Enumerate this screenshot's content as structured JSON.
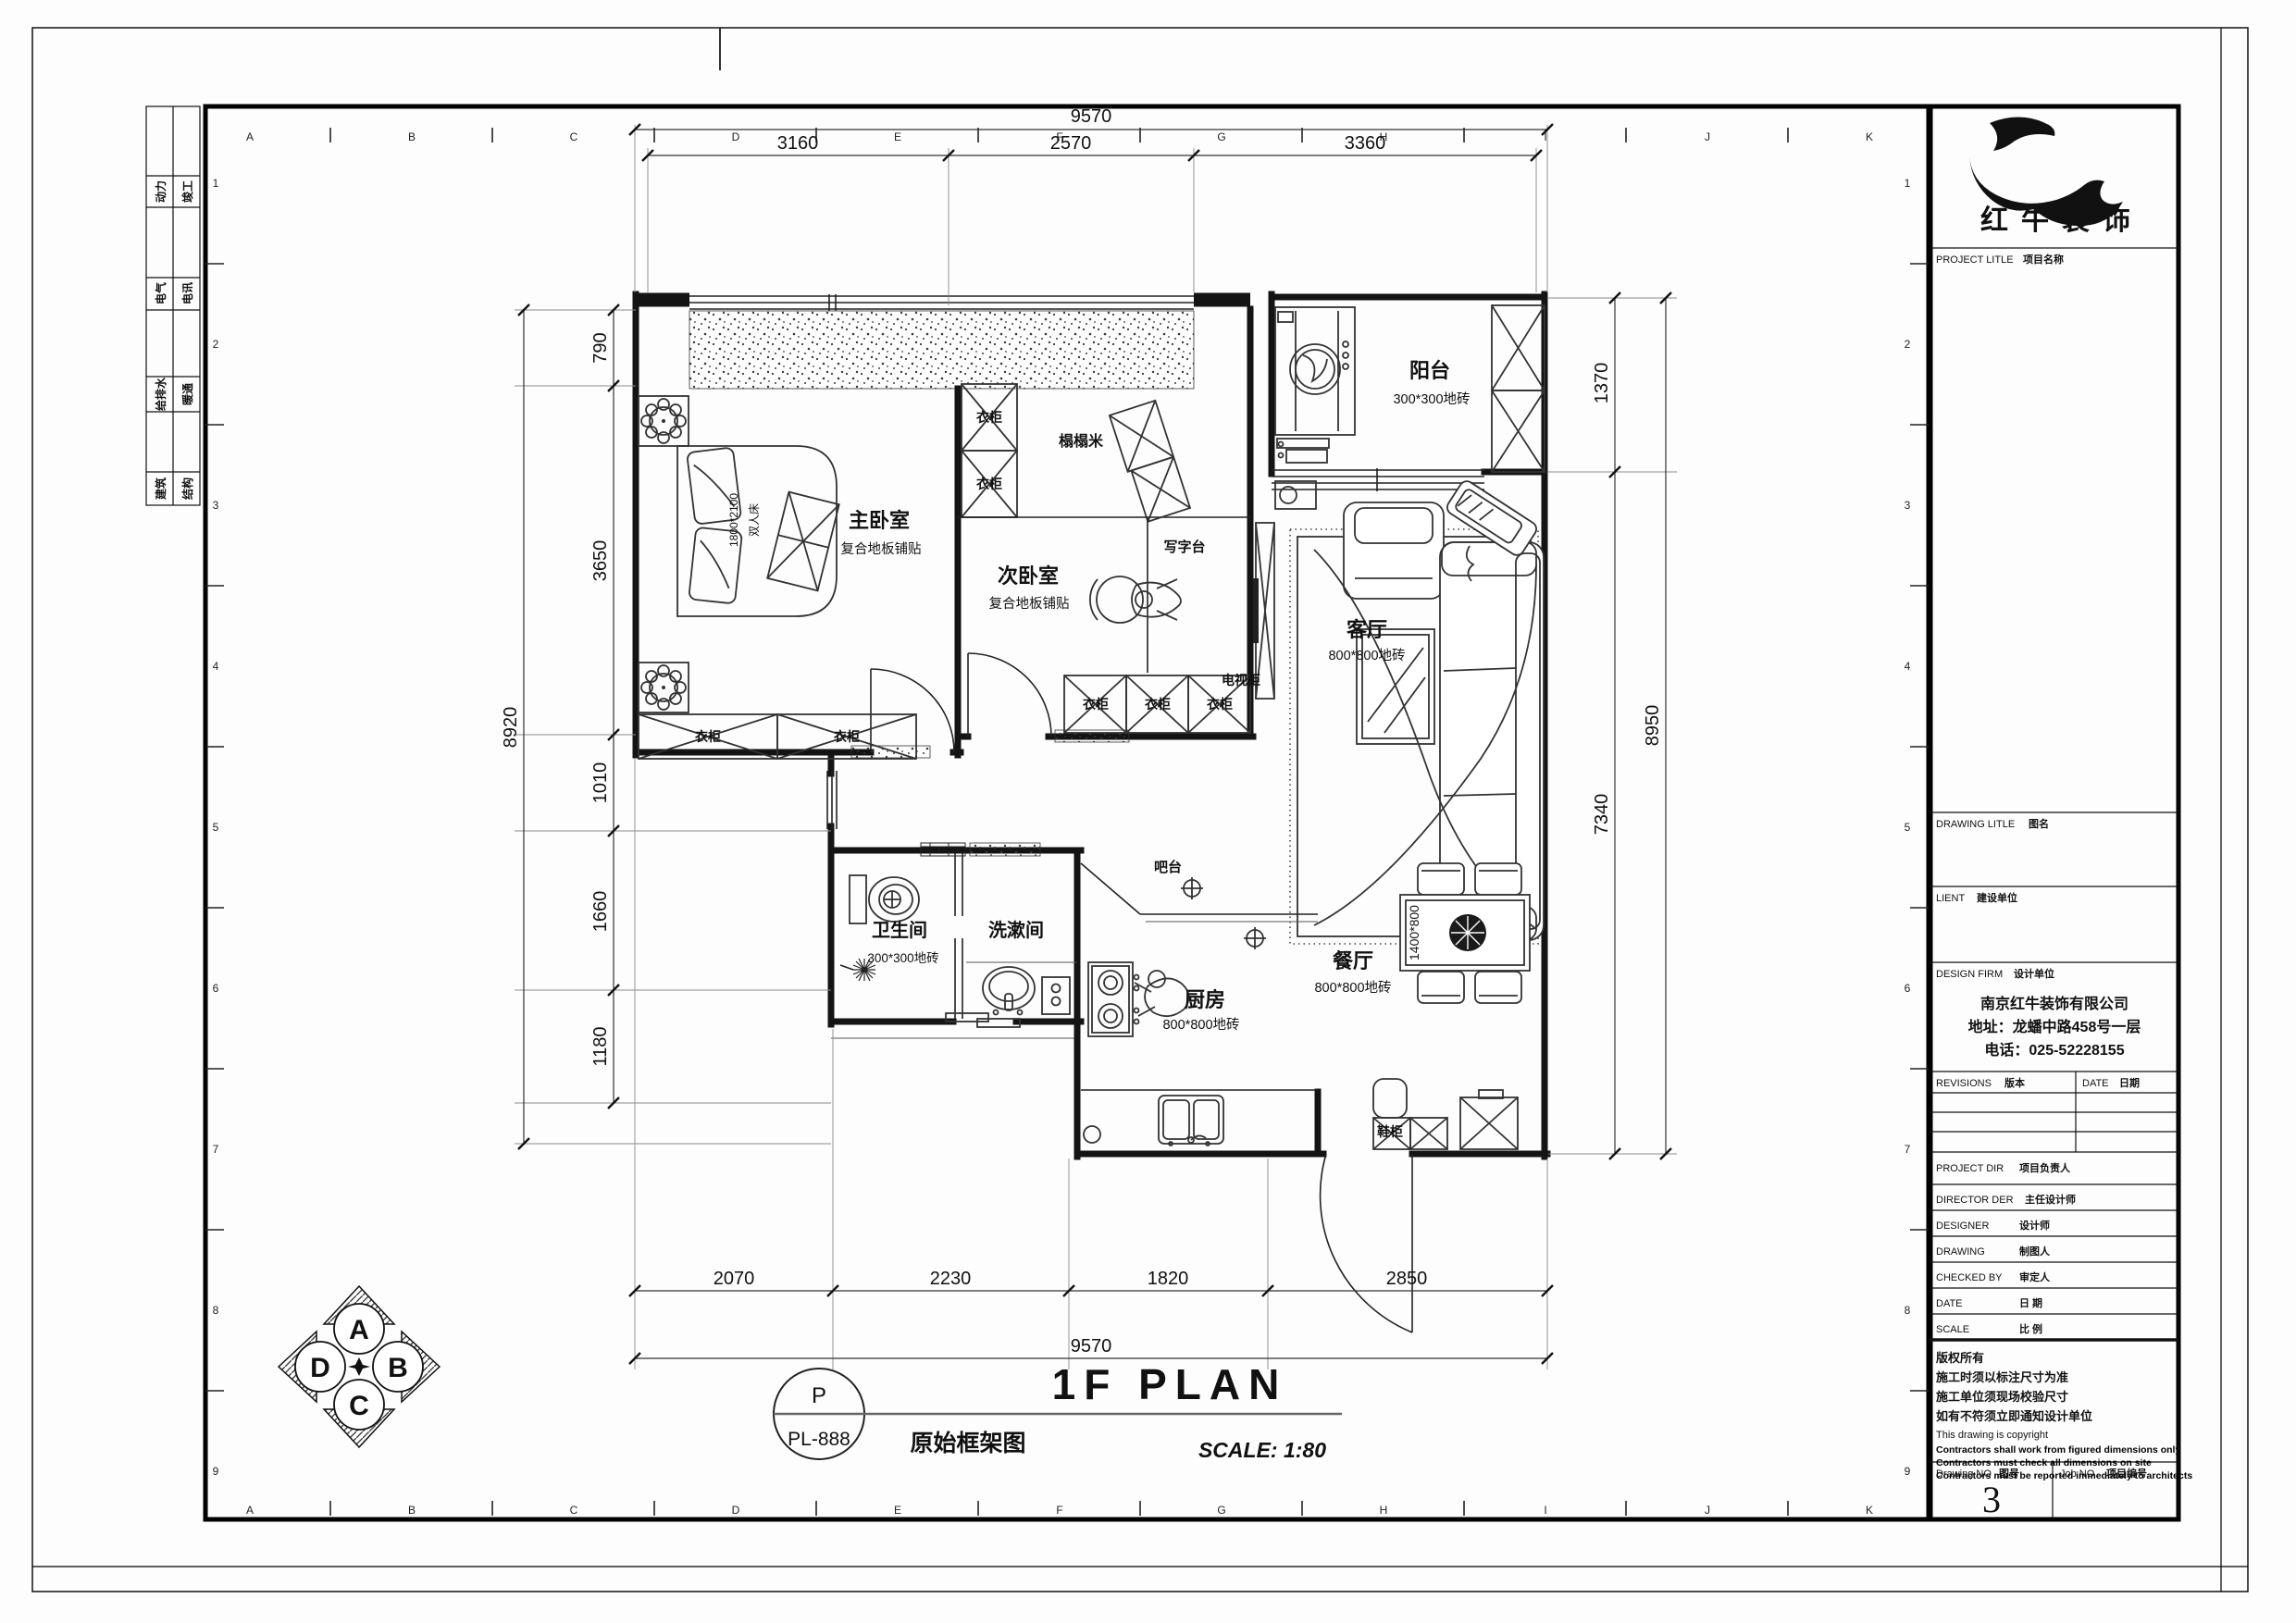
{
  "sheet": {
    "grid": {
      "letters": [
        "A",
        "B",
        "C",
        "D",
        "E",
        "F",
        "G",
        "H",
        "I",
        "J",
        "K"
      ],
      "numbers": [
        "1",
        "2",
        "3",
        "4",
        "5",
        "6",
        "7",
        "8",
        "9"
      ]
    },
    "disciplines": [
      {
        "c1": "动力",
        "c2": "竣工"
      },
      {
        "c1": "电气",
        "c2": "电讯"
      },
      {
        "c1": "给排水",
        "c2": "暖通"
      },
      {
        "c1": "建筑",
        "c2": "结构"
      }
    ]
  },
  "title_block": {
    "logo_text": "红牛装饰",
    "project_title_en": "PROJECT LITLE",
    "project_title_cn": "项目名称",
    "drawing_title_en": "DRAWING LITLE",
    "drawing_title_cn": "图名",
    "client_en": "LIENT",
    "client_cn": "建设单位",
    "design_firm_en": "DESIGN FIRM",
    "design_firm_cn": "设计单位",
    "company": {
      "name": "南京红牛装饰有限公司",
      "address": "地址：龙蟠中路458号一层",
      "phone": "电话：025-52228155"
    },
    "revisions_en": "REVISIONS",
    "revisions_cn": "版本",
    "date_en": "DATE",
    "date_cn": "日期",
    "project_dir_en": "PROJECT DIR",
    "project_dir_cn": "项目负责人",
    "director_en": "DIRECTOR DER",
    "director_cn": "主任设计师",
    "designer_en": "DESIGNER",
    "designer_cn": "设计师",
    "drawing_en": "DRAWING",
    "drawing_cn": "制图人",
    "checked_en": "CHECKED BY",
    "checked_cn": "审定人",
    "date2_en": "DATE",
    "date2_cn": "日  期",
    "scale_en": "SCALE",
    "scale_cn": "比  例",
    "copyright": [
      "版权所有",
      "施工时须以标注尺寸为准",
      "施工单位须现场校验尺寸",
      "如有不符须立即通知设计单位",
      "This drawing is copyright",
      "Contractors shall work from figured dimensions only",
      "Contractors must check all dimensions on site",
      "Contractors must be reported immediately to architects"
    ],
    "drawing_no_en": "Drawing NO",
    "drawing_no_cn": "图号",
    "drawing_no": "3",
    "job_no_en": "Job NO",
    "job_no_cn": "项目编号"
  },
  "plan": {
    "rooms": {
      "master": {
        "name": "主卧室",
        "floor": "复合地板铺贴"
      },
      "second": {
        "name": "次卧室",
        "floor": "复合地板铺贴"
      },
      "balcony": {
        "name": "阳台",
        "floor": "300*300地砖"
      },
      "living": {
        "name": "客厅",
        "floor": "800*800地砖"
      },
      "dining": {
        "name": "餐厅",
        "floor": "800*800地砖"
      },
      "kitchen": {
        "name": "厨房",
        "floor": "800*800地砖"
      },
      "bath": {
        "name": "卫生间",
        "floor": "300*300地砖"
      },
      "wash": {
        "name": "洗漱间"
      }
    },
    "furniture": {
      "wardrobe": "衣柜",
      "bed_size": "1800*2100",
      "bed_name": "双人床",
      "tatami": "榻榻米",
      "desk": "写字台",
      "tv_cabinet": "电视柜",
      "bar": "吧台",
      "shoe_cabinet": "鞋柜",
      "dining_table_size": "1400*800"
    }
  },
  "dims": {
    "top": {
      "overall": "9570",
      "segments": [
        "3160",
        "2570",
        "3360"
      ]
    },
    "bottom": {
      "overall": "9570",
      "segments": [
        "2070",
        "2230",
        "1820",
        "2850"
      ]
    },
    "left": {
      "overall": "8920",
      "segments": [
        "790",
        "3650",
        "1010",
        "1660",
        "1180"
      ]
    },
    "right": {
      "overall": "8950",
      "segments": [
        "1370",
        "7340"
      ]
    }
  },
  "titlebar": {
    "circle_top": "P",
    "circle_bottom": "PL-888",
    "plan_title": "1F PLAN",
    "plan_subtitle": "原始框架图",
    "scale": "SCALE: 1:80"
  },
  "compass": {
    "n": "A",
    "e": "B",
    "s": "C",
    "w": "D"
  }
}
